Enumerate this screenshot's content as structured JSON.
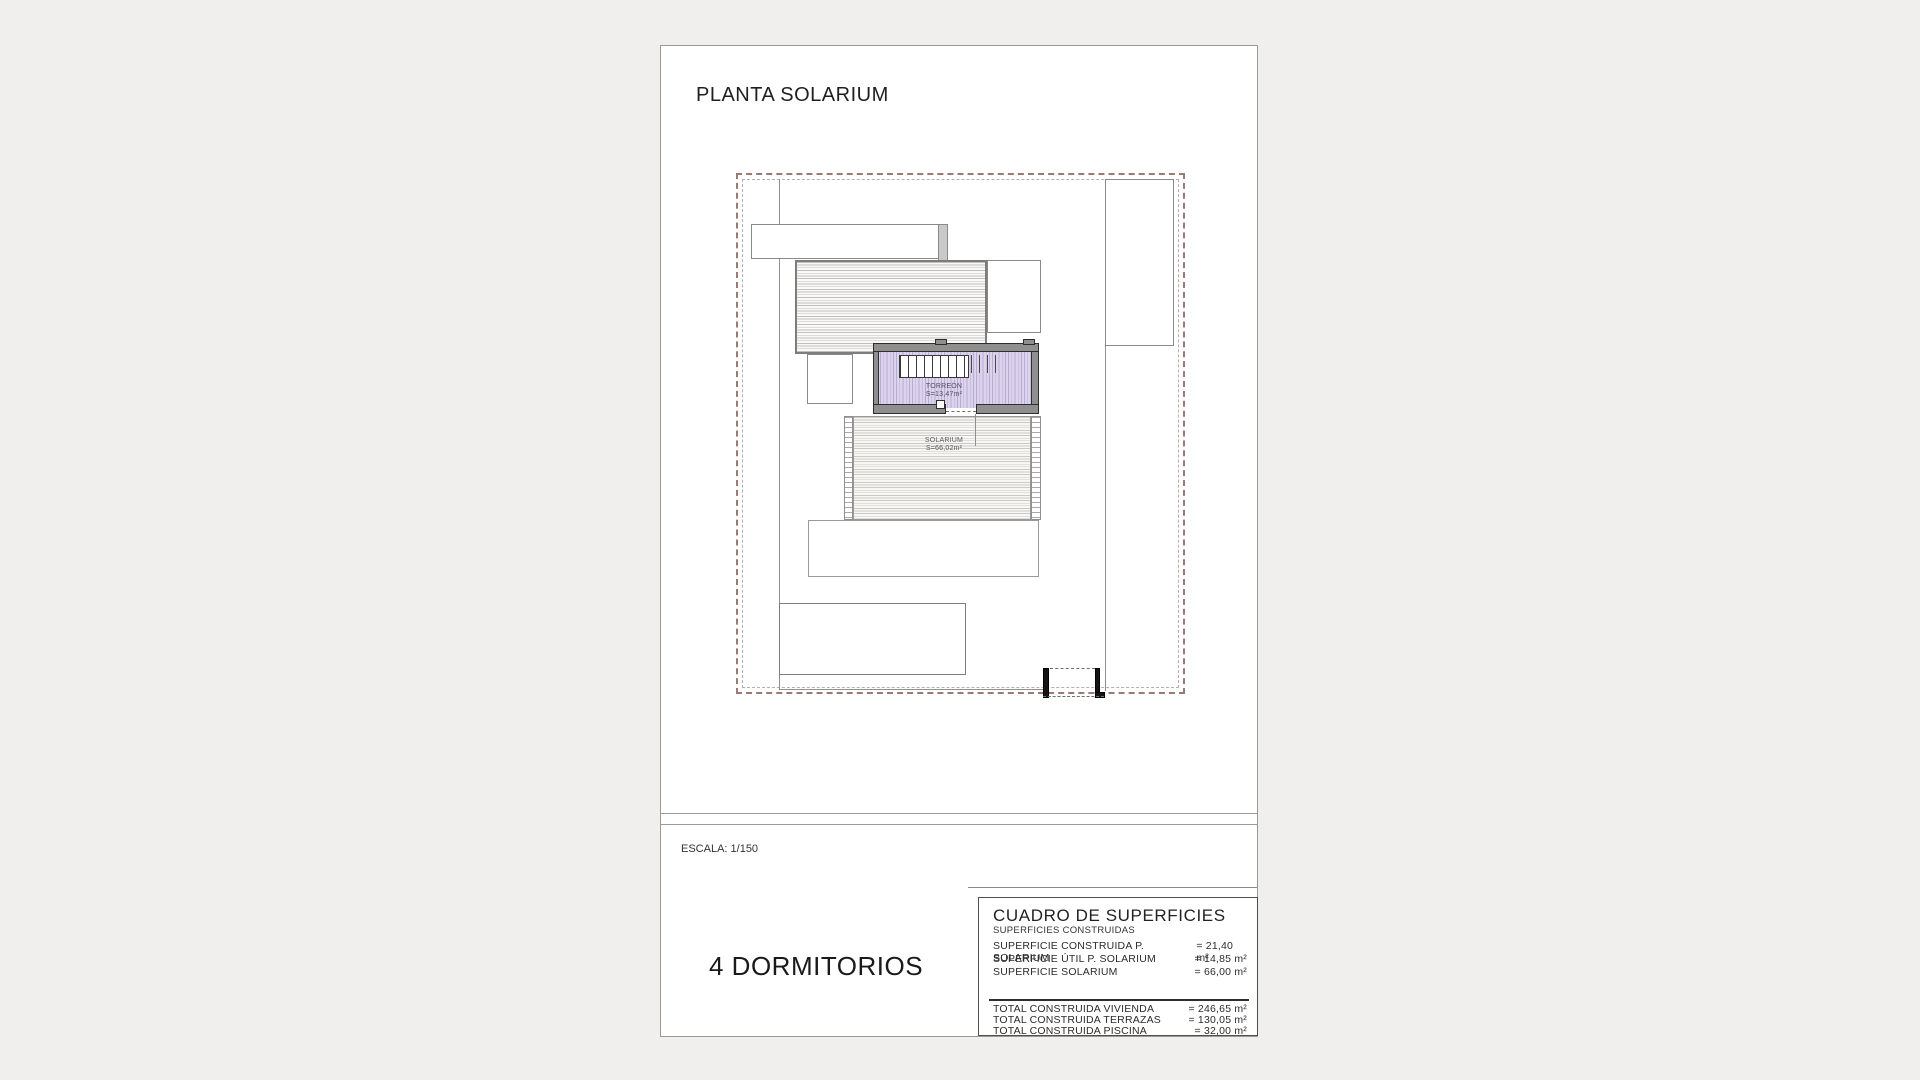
{
  "page": {
    "title": "PLANTA SOLARIUM",
    "scale_label": "ESCALA: 1/150",
    "bedrooms_label": "4 DORMITORIOS"
  },
  "plan": {
    "torreon": {
      "name": "TORREÓN",
      "area": "S=13,47m²"
    },
    "solarium": {
      "name": "SOLARIUM",
      "area": "S=66,02m²"
    }
  },
  "surfaces_table": {
    "title": "CUADRO DE SUPERFICIES",
    "subtitle": "SUPERFICIES CONSTRUIDAS",
    "rows": [
      {
        "label": "SUPERFICIE CONSTRUIDA P. SOLARIUM",
        "value": "= 21,40 m²"
      },
      {
        "label": "SUPERFICIE ÚTIL P. SOLARIUM",
        "value": "= 14,85 m²"
      },
      {
        "label": "SUPERFICIE SOLARIUM",
        "value": "= 66,00 m²"
      }
    ],
    "totals": [
      {
        "label": "TOTAL CONSTRUIDA VIVIENDA",
        "value": "= 246,65 m²"
      },
      {
        "label": "TOTAL CONSTRUIDA TERRAZAS",
        "value": "= 130,05 m²"
      },
      {
        "label": "TOTAL CONSTRUIDA PISCINA",
        "value": "= 32,00 m²"
      }
    ]
  },
  "colors": {
    "plot_boundary": "#9b7a73",
    "inner_boundary": "#b3b1af",
    "wall_gray": "#8f8f8f",
    "torreon_fill": "#dcd3ec",
    "paper": "#ffffff",
    "backdrop": "#f0efed"
  }
}
